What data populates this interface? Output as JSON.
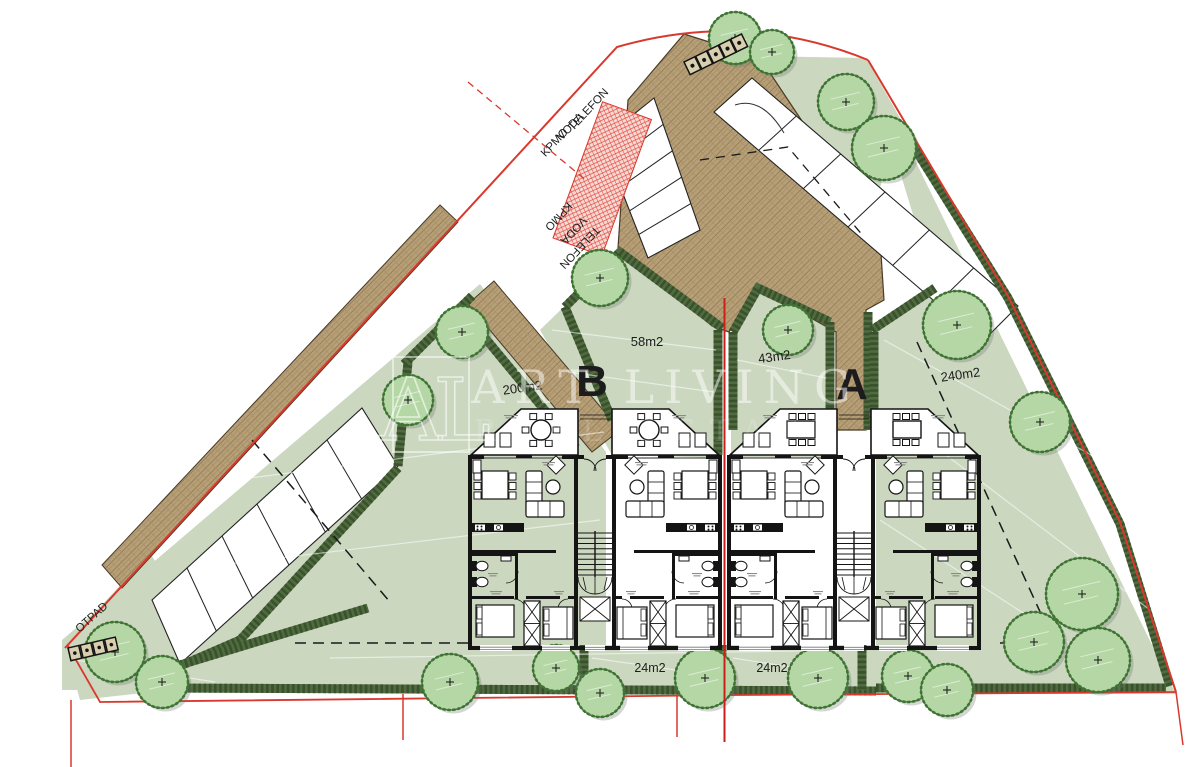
{
  "plan": {
    "title": "residential site plan",
    "buildings": [
      {
        "label": "B"
      },
      {
        "label": "A"
      }
    ],
    "areas": [
      "200m2",
      "58m2",
      "43m2",
      "240m2",
      "24m2",
      "24m2"
    ],
    "utilities_top": [
      "TELEFON",
      "VODA",
      "KPMO"
    ],
    "utilities_bottom": [
      "KPMO",
      "VODA",
      "TELEFON"
    ],
    "waste_label": "OTPAD"
  },
  "watermark": {
    "logo": "AL",
    "title": "ART LIVING",
    "subtitle": "REAL ESTATE"
  },
  "colors": {
    "boundary_red": "#d8392c",
    "utility_hatch_red": "#e0453a",
    "garden_green": "#cbd7bf",
    "hedge_green": "#4f6b40",
    "hedge_dark": "#3a512c",
    "tree_green": "#b5d7a6",
    "tree_outline": "#3f7434",
    "paving_brown": "#b7a078",
    "paving_line": "#8f7852",
    "wall_black": "#141414"
  }
}
